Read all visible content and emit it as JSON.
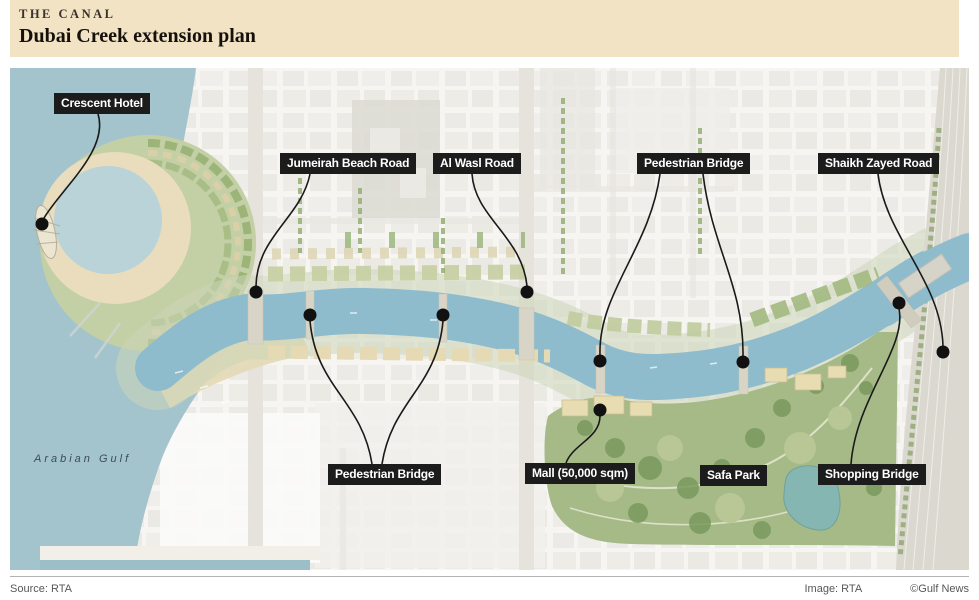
{
  "header": {
    "kicker": "THE CANAL",
    "title": "Dubai Creek extension plan"
  },
  "map": {
    "sea_label": "Arabian Gulf",
    "annotations": [
      {
        "id": "crescent-hotel",
        "text": "Crescent Hotel"
      },
      {
        "id": "jumeirah-beach-road",
        "text": "Jumeirah Beach Road"
      },
      {
        "id": "al-wasl-road",
        "text": "Al Wasl Road"
      },
      {
        "id": "pedestrian-bridge-top",
        "text": "Pedestrian Bridge"
      },
      {
        "id": "shaikh-zayed-road",
        "text": "Shaikh Zayed Road"
      },
      {
        "id": "pedestrian-bridge-bottom",
        "text": "Pedestrian Bridge"
      },
      {
        "id": "mall",
        "text": "Mall (50,000 sqm)"
      },
      {
        "id": "safa-park",
        "text": "Safa Park"
      },
      {
        "id": "shopping-bridge",
        "text": "Shopping Bridge"
      }
    ]
  },
  "footer": {
    "source": "Source: RTA",
    "image_credit": "Image: RTA",
    "copyright": "©Gulf News"
  },
  "colors": {
    "header_bg": "#f2e3c5",
    "label_bg": "#1c1c1c",
    "label_text": "#ffffff",
    "sea": "#a4c4cd",
    "canal": "#8fbccd",
    "park": "#a6ba87",
    "highway": "#dbd8cf",
    "city": "#f5f4f1"
  }
}
